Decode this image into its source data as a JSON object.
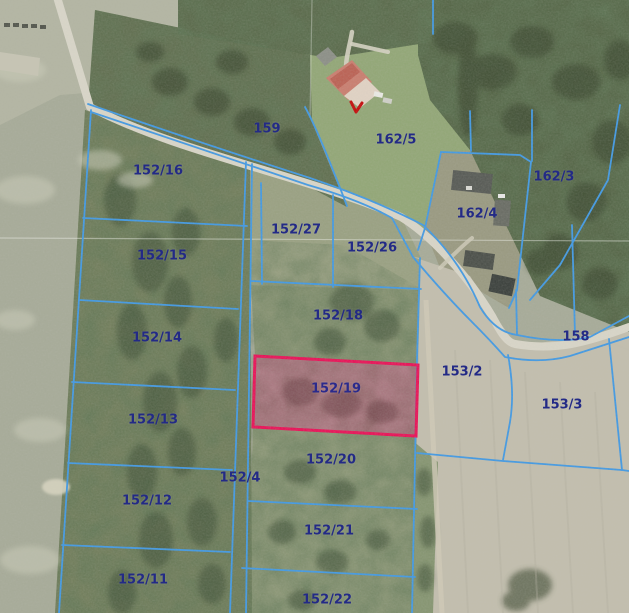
{
  "map": {
    "type": "cadastral-aerial-view",
    "colors": {
      "boundary": "#459ae2",
      "label": "#232a86",
      "highlight_border": "#e7175a",
      "highlight_fill": "rgba(195,35,100,0.33)",
      "marker": "#c41111",
      "road": "#d8d5c8"
    },
    "highlighted_parcel": "152/19",
    "parcels": [
      {
        "label": "159",
        "highlighted": false
      },
      {
        "label": "162/5",
        "highlighted": false
      },
      {
        "label": "152/16",
        "highlighted": false
      },
      {
        "label": "162/3",
        "highlighted": false
      },
      {
        "label": "162/4",
        "highlighted": false
      },
      {
        "label": "152/27",
        "highlighted": false
      },
      {
        "label": "152/26",
        "highlighted": false
      },
      {
        "label": "152/15",
        "highlighted": false
      },
      {
        "label": "152/18",
        "highlighted": false
      },
      {
        "label": "152/14",
        "highlighted": false
      },
      {
        "label": "158",
        "highlighted": false
      },
      {
        "label": "153/2",
        "highlighted": false
      },
      {
        "label": "152/19",
        "highlighted": true
      },
      {
        "label": "153/3",
        "highlighted": false
      },
      {
        "label": "152/13",
        "highlighted": false
      },
      {
        "label": "152/20",
        "highlighted": false
      },
      {
        "label": "152/4",
        "highlighted": false
      },
      {
        "label": "152/12",
        "highlighted": false
      },
      {
        "label": "152/21",
        "highlighted": false
      },
      {
        "label": "152/11",
        "highlighted": false
      },
      {
        "label": "152/22",
        "highlighted": false
      }
    ]
  }
}
